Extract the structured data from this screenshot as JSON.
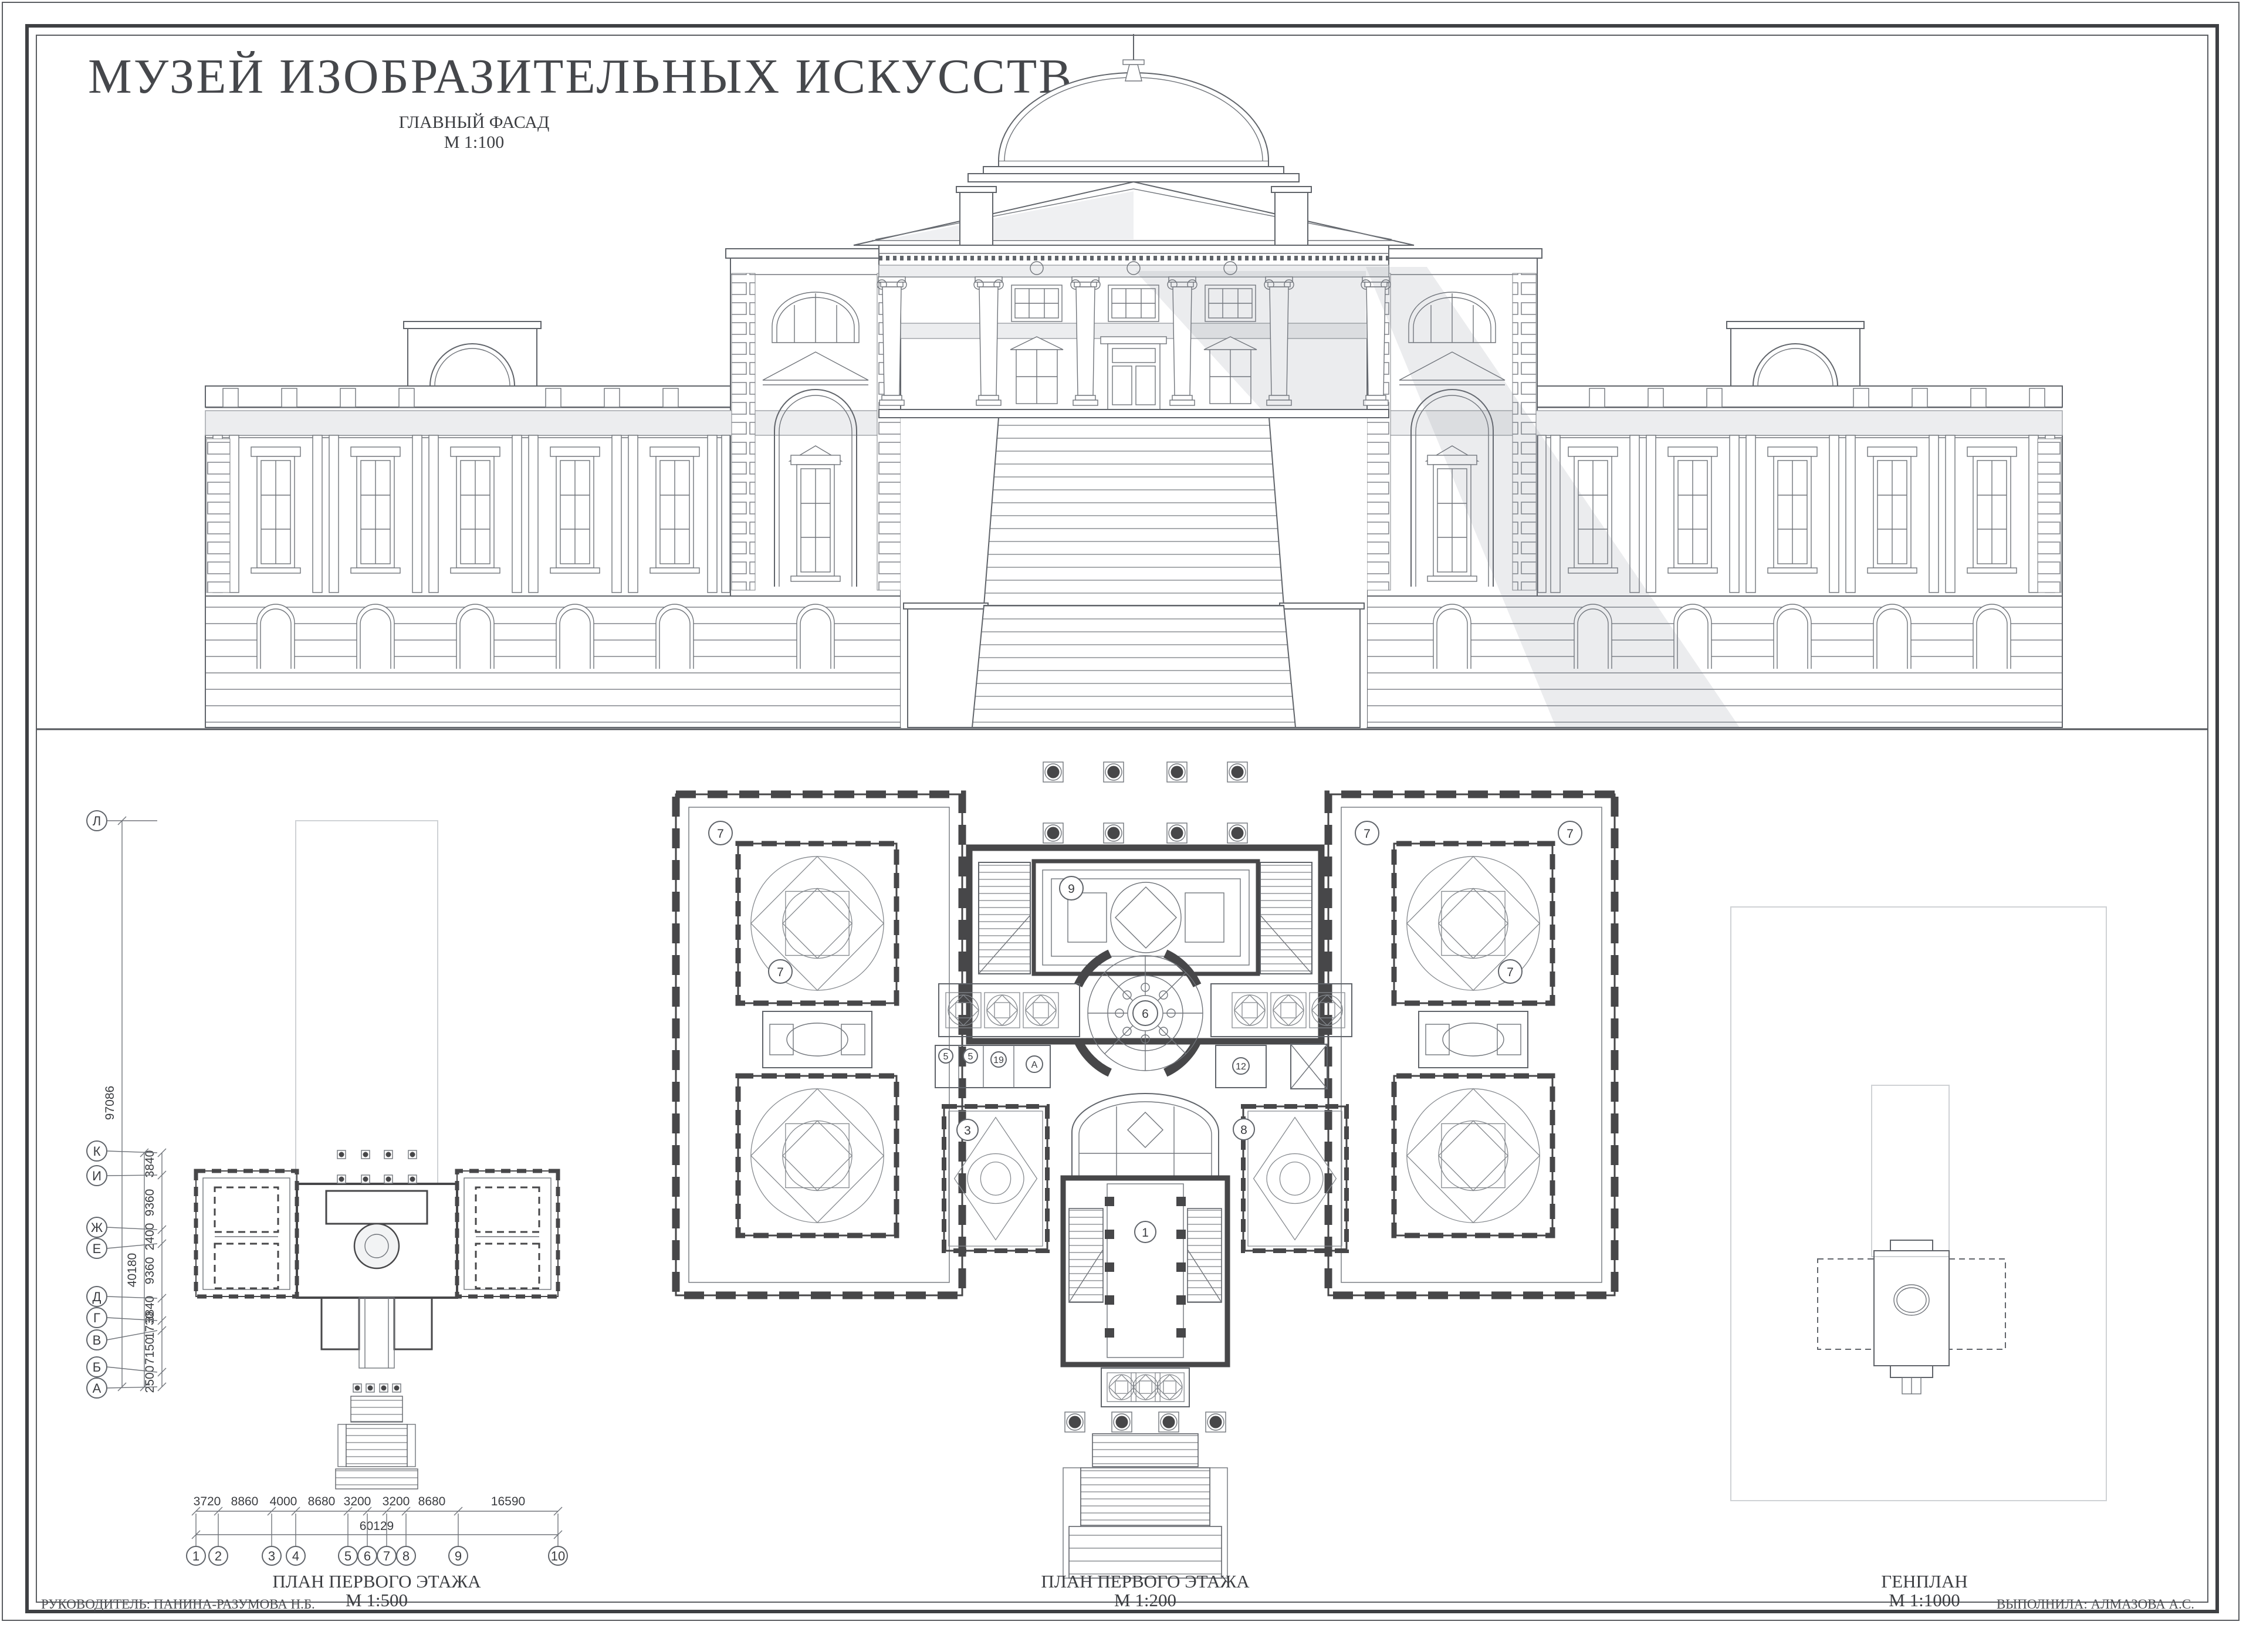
{
  "sheet": {
    "title": "МУЗЕЙ ИЗОБРАЗИТЕЛЬНЫХ ИСКУССТВ",
    "credit_left": "РУКОВОДИТЕЛЬ: ПАНИНА-РАЗУМОВА Н.Б.",
    "credit_right": "ВЫПОЛНИЛА: АЛМАЗОВА А.С."
  },
  "views": {
    "facade": {
      "title": "ГЛАВНЫЙ ФАСАД",
      "scale": "М 1:100"
    },
    "plan500": {
      "title": "ПЛАН ПЕРВОГО ЭТАЖА",
      "scale": "М 1:500"
    },
    "plan200": {
      "title": "ПЛАН ПЕРВОГО ЭТАЖА",
      "scale": "М 1:200"
    },
    "genplan": {
      "title": "ГЕНПЛАН",
      "scale": "М 1:1000"
    }
  },
  "axes": {
    "rows": [
      "Л",
      "К",
      "И",
      "Ж",
      "Е",
      "Д",
      "Г",
      "В",
      "Б",
      "А"
    ],
    "row_segments": [
      "3840",
      "9360",
      "2400",
      "9360",
      "3840",
      "1730",
      "7150",
      "2500"
    ],
    "row_total_inner": "40180",
    "row_total_outer": "97086",
    "cols": [
      "1",
      "2",
      "3",
      "4",
      "5",
      "6",
      "7",
      "8",
      "9",
      "10"
    ],
    "col_segments": [
      "3720",
      "8860",
      "4000",
      "8680",
      "3200",
      "3200",
      "8680",
      "16590"
    ],
    "col_total": "60129"
  },
  "room_labels": [
    "7",
    "7",
    "7",
    "7",
    "7",
    "9",
    "6",
    "5",
    "5",
    "19",
    "А",
    "12",
    "3",
    "8",
    "1"
  ]
}
